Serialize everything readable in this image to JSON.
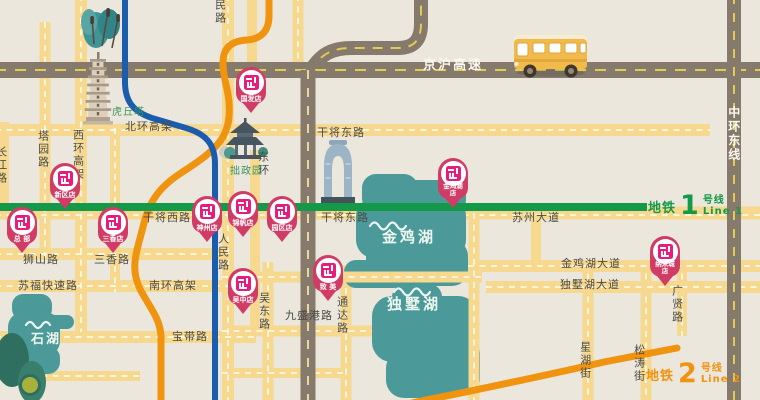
{
  "labels": {
    "beihuan": "北环高架",
    "tayuan": "塔园路",
    "xihuan": "西环高架",
    "changjiang": "长江路",
    "renmin": "人民路",
    "huqiu": "虎丘塔",
    "zhuozheng": "拙政园",
    "donghuan": "东环",
    "ganjiang_xi": "干将西路",
    "ganjiang_dong": "干将东路",
    "suzhou_dadao": "苏州大道",
    "jinghu_gaosu": "京沪高速",
    "zhonghuan_dongxian": "中环东线",
    "shishan": "狮山路",
    "sanxiang": "三香路",
    "sufu": "苏福快速路",
    "nanhuan": "南环高架",
    "baodai": "宝带路",
    "wudong": "吴东路",
    "jiusheng": "九盛港路",
    "tongda": "通达路",
    "xinghu": "星湖街",
    "songtao": "松涛街",
    "jinjihu_dadao": "金鸡湖大道",
    "dushuhu_dadao": "独墅湖大道",
    "guangxian": "广贤路"
  },
  "lakes": {
    "jinji": "金鸡湖",
    "dushu": "独墅湖",
    "shihu": "石湖"
  },
  "metro_lines": [
    {
      "prefix": "地铁",
      "number": "1",
      "suffix": "号线",
      "en": "Line 1",
      "color": "#149948"
    },
    {
      "prefix": "地铁",
      "number": "2",
      "suffix": "号线",
      "en": "Line 2",
      "color": "#f0930f"
    }
  ],
  "stores": [
    {
      "label": "国发店"
    },
    {
      "label": "新区店"
    },
    {
      "label": "总 部"
    },
    {
      "label": "三香店"
    },
    {
      "label": "神州店"
    },
    {
      "label": "锦帆店"
    },
    {
      "label": "园区店"
    },
    {
      "label": "金鸡湖店"
    },
    {
      "label": "吴中店"
    },
    {
      "label": "致 美"
    },
    {
      "label": "纳米城店"
    }
  ],
  "colors": {
    "background": "#ece7dd",
    "road": "#f6d88e",
    "highway": "#867a6d",
    "highway_dash": "#e0cb55",
    "lake": "#4b9a99",
    "line1_green": "#149948",
    "line2_orange": "#f0930f",
    "line_blue": "#1b5dad",
    "pin_body": "#d13c66",
    "pin_logo": "#e81c7c"
  }
}
